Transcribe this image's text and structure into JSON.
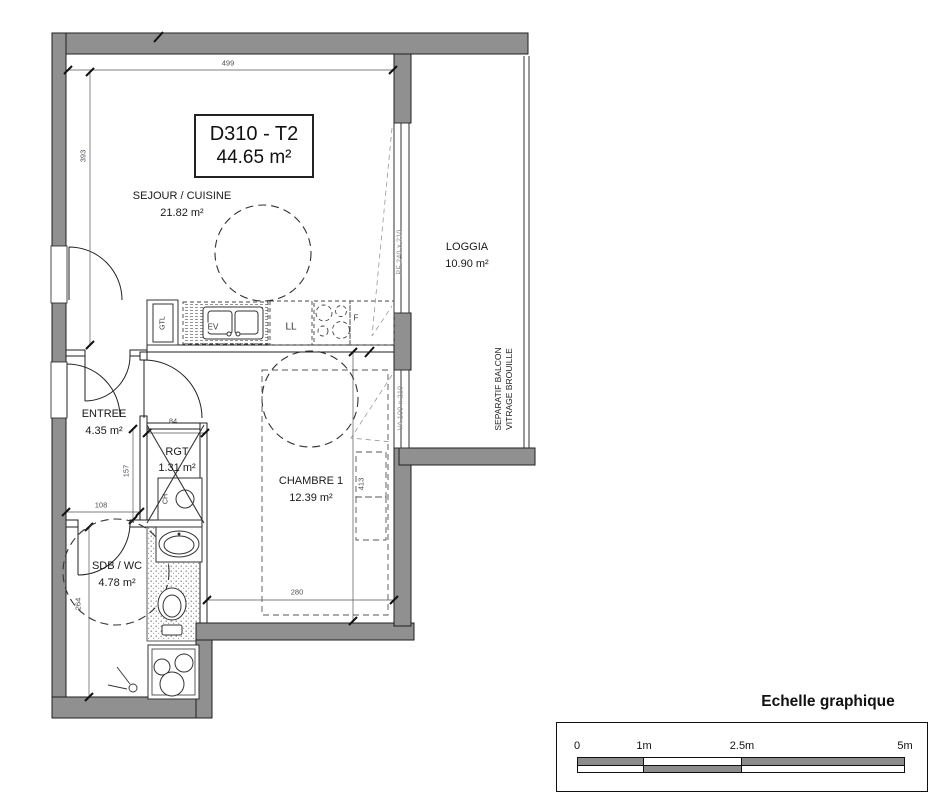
{
  "plan": {
    "title_block": {
      "code": "D310 - T2",
      "area": "44.65 m²"
    },
    "rooms": [
      {
        "name": "SEJOUR / CUISINE",
        "area": "21.82 m²"
      },
      {
        "name": "LOGGIA",
        "area": "10.90 m²"
      },
      {
        "name": "ENTREE",
        "area": "4.35 m²"
      },
      {
        "name": "RGT",
        "area": "1.31 m²"
      },
      {
        "name": "CHAMBRE 1",
        "area": "12.39 m²"
      },
      {
        "name": "SDB / WC",
        "area": "4.78 m²"
      }
    ],
    "dimensions": {
      "sejour_width": "499",
      "sejour_height": "393",
      "rgt_width": "84",
      "rgt_height": "157",
      "entree_width": "108",
      "chambre_width": "280",
      "chambre_height": "413",
      "sdb_height": "264"
    },
    "fixtures": {
      "gtl": "GTL",
      "sink": "EV",
      "washing_machine": "LL",
      "fridge": "F",
      "water_heater": "CH"
    },
    "windows": {
      "loggia_door": "PF 240 x 210",
      "bedroom_window": "VA 100 x 210"
    },
    "separator": {
      "line1": "SEPARATIF BALCON",
      "line2": "VITRAGE BROUILLE"
    },
    "colors": {
      "wall": "#909090",
      "line": "#1f1f1f",
      "scale_gray": "#8c8c8c"
    }
  },
  "scale_legend": {
    "title": "Echelle graphique",
    "tick_0": "0",
    "tick_1": "1m",
    "tick_2": "2.5m",
    "tick_3": "5m"
  }
}
